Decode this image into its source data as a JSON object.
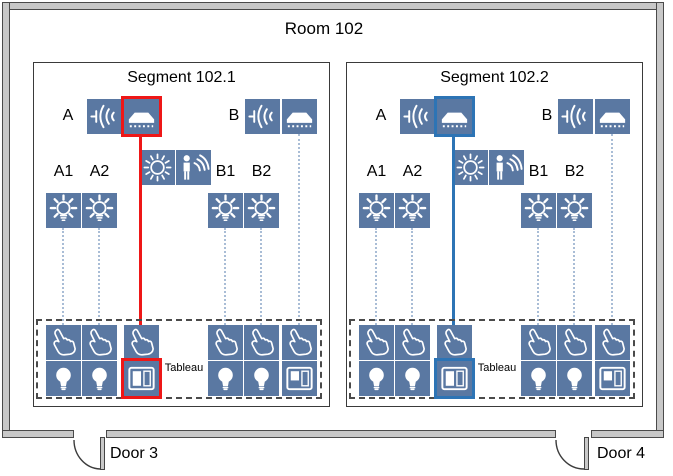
{
  "room": {
    "title": "Room 102"
  },
  "doors": [
    {
      "label": "Door 3"
    },
    {
      "label": "Door 4"
    }
  ],
  "segments": [
    {
      "title": "Segment 102.1",
      "selection_color": "#ee1717",
      "zone_a": {
        "label": "A",
        "lamps": [
          "A1",
          "A2"
        ]
      },
      "zone_b": {
        "label": "B",
        "lamps": [
          "B1",
          "B2"
        ]
      },
      "tableau_label": "Tableau"
    },
    {
      "title": "Segment 102.2",
      "selection_color": "#2d74b5",
      "zone_a": {
        "label": "A",
        "lamps": [
          "A1",
          "A2"
        ]
      },
      "zone_b": {
        "label": "B",
        "lamps": [
          "B1",
          "B2"
        ]
      },
      "tableau_label": "Tableau"
    }
  ],
  "icons": {
    "sound_emitter_icon": "speaker-with-sound-waves",
    "ceiling_panel_icon": "flat-ceiling-emitter-panel",
    "light_sensor_icon": "sun",
    "presence_sensor_icon": "person-with-waves",
    "lamp_icon": "shining-bulb",
    "pushbutton_icon": "pointing-hand",
    "indicator_lamp_icon": "solid-bulb",
    "tableau_panel_icon": "split-window-panel"
  },
  "colors": {
    "device_bg": "#5a78a2",
    "select_red": "#ee1717",
    "select_blue": "#2d74b5",
    "connector": "#a9bdd6",
    "wall_fill": "#c8c8c8"
  }
}
